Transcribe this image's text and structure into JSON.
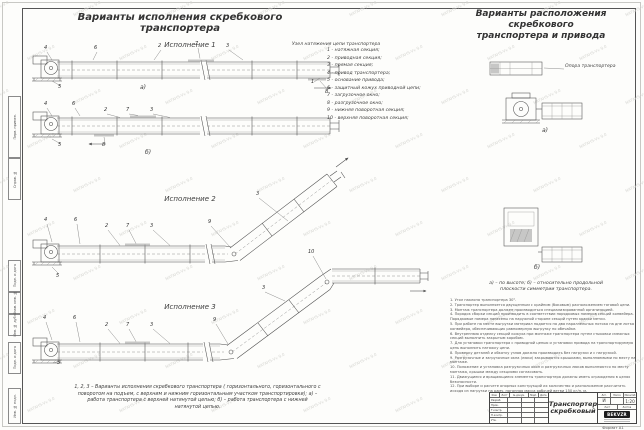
{
  "titles": {
    "left": "Варианты исполнения скребкового транспортера",
    "right_line1": "Варианты расположения скребкового",
    "right_line2": "транспортера и привода"
  },
  "labels": {
    "execution1": "Исполнение  1",
    "execution2": "Исполнение  2",
    "execution3": "Исполнение  3",
    "view_a": "а)",
    "view_b": "б)",
    "tension_unit_note": "Узел натяжения цепи транспортера",
    "support_note": "Опора транспортера"
  },
  "parts_list": [
    "1  -  натяжная секция;",
    "2  -  приводная секция;",
    "3  -  прямая секция;",
    "4  -  привод транспортера;",
    "5  -  основание привода;",
    "6  -  защитный кожух приводной цепи;",
    "7  -  загрузочное окно;",
    "8  -  разгрузочное окно;",
    "9  -  нижняя поворотная секция;",
    "10 -  верхняя поворотная секция;"
  ],
  "captions": {
    "left_bottom_1": "1, 2, 3  –  Варианты исполнения скребкового транспортера ( горизонтального, горизонтального с",
    "left_bottom_2": "поворотом на подъем, с верхним и нижним горизонтальным участком транспортировки);  а) –",
    "left_bottom_3": "работа транспортера с верхней натянутой цепью;  б) –   работа транспортера с нижней",
    "left_bottom_4": "натянутой цепью.",
    "right_views_1": "а) – по высоте;  б) –  относительно продольной",
    "right_views_2": "плоскости симметрии транспортера."
  },
  "notes": [
    "1. Угол наклона транспортера 30°.",
    "2. Транспортер выполняется двухцепным с крайним (боковым) расположением тяговой цепи.",
    "3. Монтаж транспортера должен производиться специализированной организацией.",
    "4. Порядок сборки секций производить в соответствии порядковых номеров секций конвейера. Порядковые номера нанесены на наружной стороне секций путем краски метки.",
    "5. При работе на месте выгрузки материал подается на два параллельных потока на дне лотка конвейера, обеспечивающих равномерную выгрузку по обечайке.",
    "6. Внутреннюю отделку секций кожуха при монтаже транспортера путем стыковки смежных секций выполнить закрытым коробом.",
    "7. Для установки транспортера с приводной цепью и установки привода на транспортируемую цепь выполнить натяжку цепи.",
    "8. Проверку деталей и обкатку узлов должно производить без нагрузки и с нагрузкой.",
    "9. Разгрузочные и загрузочные окна (люки) закрываются крышками, выполняемыми по месту на монтаже.",
    "10. Положение и установка разгрузочных окон и разгрузочных люков выполняются по месту монтажа, крышки между секциями согласовать.",
    "11. Движущиеся и вращающиеся элементы транспортера должны иметь ограждения в целях безопасности.",
    "12. При выборе и расчете опорных конструкций их количество и расположение рассчитать исходя из нагрузки на раму, погонная масса рабочей ветви 150 кг/п. м."
  ],
  "callouts": {
    "i1a": [
      "4",
      "6",
      "2",
      "7",
      "3",
      "5",
      "1",
      "8"
    ],
    "i1b": [
      "4",
      "6",
      "2",
      "7",
      "3",
      "5",
      "8"
    ],
    "i2": [
      "4",
      "6",
      "2",
      "7",
      "3",
      "9",
      "3",
      "5"
    ],
    "i3": [
      "4",
      "6",
      "2",
      "7",
      "3",
      "9",
      "3",
      "10",
      "5"
    ]
  },
  "title_block": {
    "doc_name_line1": "Транспортер",
    "doc_name_line2": "скребковый",
    "header_cols": [
      "Изм.",
      "Лист",
      "№ докум.",
      "Подп.",
      "Дата"
    ],
    "row_labels": [
      "Разраб.",
      "Пров.",
      "Т.контр.",
      "Н.контр.",
      "Утв."
    ],
    "lit_header": "Лит.",
    "mass_header": "Масса",
    "scale_header": "Масштаб",
    "lit_value": "И",
    "scale_value": "1:20",
    "sheet_label": "Лист",
    "sheets_label": "Листов",
    "logo_text": "BEKVZR",
    "format_label": "Формат А1"
  },
  "frame_labels": [
    "Перв. примен.",
    "Справ. №",
    "Подп. и дата",
    "Взам. инв. №",
    "Инв. № дубл.",
    "Подп. и дата",
    "Инв. № подл."
  ],
  "watermark_text": "NATAHS-Vv 9.0"
}
